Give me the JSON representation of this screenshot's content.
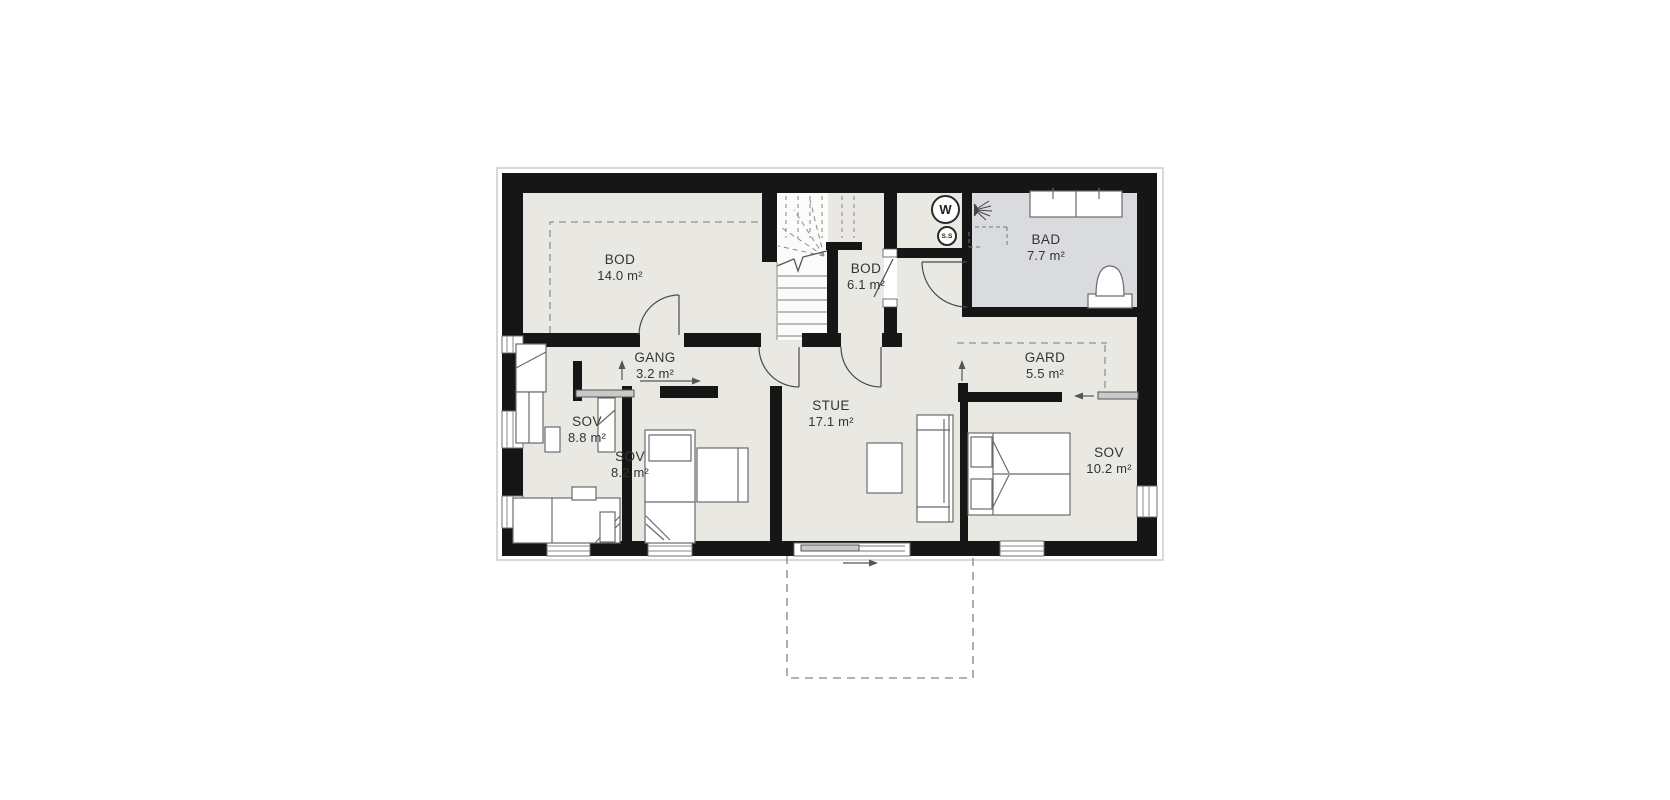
{
  "plan": {
    "title": "floor-plan",
    "rooms": [
      {
        "id": "bod-14",
        "name": "BOD",
        "area": "14.0 m²"
      },
      {
        "id": "bod-61",
        "name": "BOD",
        "area": "6.1 m²"
      },
      {
        "id": "bad",
        "name": "BAD",
        "area": "7.7 m²"
      },
      {
        "id": "gang",
        "name": "GANG",
        "area": "3.2 m²"
      },
      {
        "id": "gard",
        "name": "GARD",
        "area": "5.5 m²"
      },
      {
        "id": "sov-88",
        "name": "SOV",
        "area": "8.8 m²"
      },
      {
        "id": "sov-82",
        "name": "SOV",
        "area": "8.2 m²"
      },
      {
        "id": "stue",
        "name": "STUE",
        "area": "17.1 m²"
      },
      {
        "id": "sov-102",
        "name": "SOV",
        "area": "10.2 m²"
      }
    ],
    "appliance_badges": {
      "washer": "W",
      "dryer": "S.S"
    },
    "colors": {
      "wall": "#161616",
      "floor": "#e9e8e3",
      "bathroom_floor": "#d9dbde",
      "furniture_stroke": "#666666",
      "door_stroke": "#4a4a4a",
      "dashed_line": "#8f8f8f",
      "terrace_dash": "#9a9a9a",
      "background": "#ffffff"
    },
    "symbols": [
      "stairs",
      "terrace-dashed-outline",
      "toilet",
      "double-sink-vanity",
      "shower-head",
      "washer-circle",
      "dryer-circle",
      "sliding-door-arrows",
      "beds",
      "sofa",
      "table",
      "wardrobes"
    ]
  }
}
